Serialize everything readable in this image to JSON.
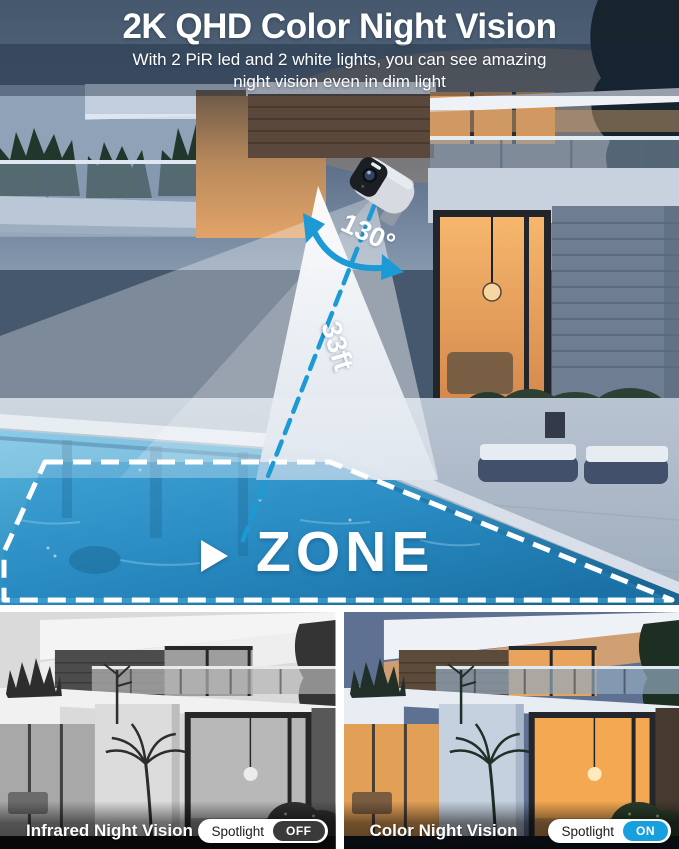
{
  "header": {
    "title": "2K QHD Color Night Vision",
    "subtitle_line1": "With 2 PiR led and 2 white lights, you can see amazing",
    "subtitle_line2": "night vision even in dim light"
  },
  "hero": {
    "angle_label": "130°",
    "distance_label": "33ft",
    "zone_label": "ZONE"
  },
  "comparison": {
    "left": {
      "caption": "Infrared Night Vision",
      "toggle": {
        "label": "Spotlight",
        "state": "OFF"
      }
    },
    "right": {
      "caption": "Color Night Vision",
      "toggle": {
        "label": "Spotlight",
        "state": "ON"
      }
    }
  },
  "icons": {
    "play": "triangle-right",
    "angle_arc": "curved-double-arrow",
    "camera": "security-camera"
  },
  "colors": {
    "accent_blue": "#1b9ad6",
    "toggle_on": "#189fdd",
    "toggle_off": "#3a3a3c",
    "zone_overlay": "rgba(31,136,203,0.30)",
    "title_text": "#ffffff"
  }
}
